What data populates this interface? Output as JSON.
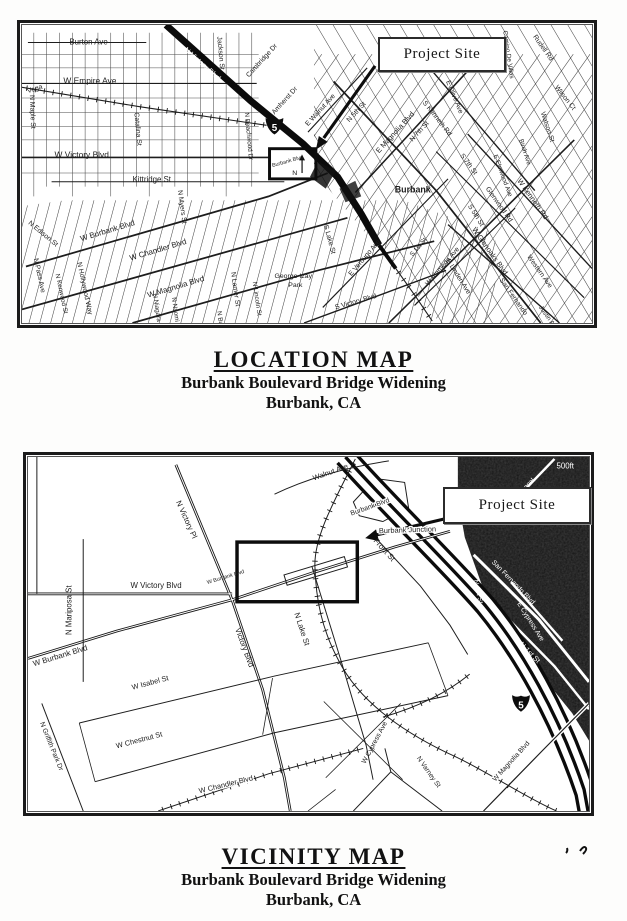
{
  "location_figure": {
    "project_site_label": "Project Site",
    "shield_label": "5",
    "compass_label": "N",
    "caption": {
      "title": "LOCATION MAP",
      "subtitle1": "Burbank Boulevard Bridge Widening",
      "subtitle2": "Burbank, CA"
    },
    "labels": [
      {
        "t": "Burton Ave",
        "x": 48,
        "y": 20,
        "r": 0,
        "s": 8
      },
      {
        "t": "W Empire Ave",
        "x": 42,
        "y": 60,
        "r": 0,
        "s": 8.5
      },
      {
        "t": "W Victory Blvd",
        "x": 33,
        "y": 136,
        "r": 0,
        "s": 8.5
      },
      {
        "t": "Kittridge St",
        "x": 112,
        "y": 161,
        "r": 0,
        "s": 8
      },
      {
        "t": "Vega",
        "x": 6,
        "y": 70,
        "r": -18,
        "s": 7
      },
      {
        "t": "N Maple St",
        "x": 8,
        "y": 72,
        "r": 88,
        "s": 7
      },
      {
        "t": "Catalina St",
        "x": 114,
        "y": 90,
        "r": 85,
        "s": 7
      },
      {
        "t": "Jackson St",
        "x": 198,
        "y": 12,
        "r": 85,
        "s": 7
      },
      {
        "t": "Cambridge Dr",
        "x": 230,
        "y": 54,
        "r": -48,
        "s": 7
      },
      {
        "t": "Amherst Dr",
        "x": 256,
        "y": 92,
        "r": -48,
        "s": 7
      },
      {
        "t": "N Victory Blvd",
        "x": 164,
        "y": 26,
        "r": 42,
        "s": 7.5,
        "c": "#ffffff"
      },
      {
        "t": "N Beachwood Dr",
        "x": 226,
        "y": 90,
        "r": 85,
        "s": 6.5
      },
      {
        "t": "E Walnut Ave",
        "x": 290,
        "y": 104,
        "r": -48,
        "s": 7
      },
      {
        "t": "N 5th St",
        "x": 332,
        "y": 100,
        "r": -48,
        "s": 7
      },
      {
        "t": "E Magnolia Blvd",
        "x": 362,
        "y": 132,
        "r": -48,
        "s": 7.5
      },
      {
        "t": "N 7th St",
        "x": 396,
        "y": 120,
        "r": -48,
        "s": 7
      },
      {
        "t": "S Kenneth Rd",
        "x": 406,
        "y": 80,
        "r": 52,
        "s": 7
      },
      {
        "t": "E Olive Ave",
        "x": 430,
        "y": 58,
        "r": 68,
        "s": 7
      },
      {
        "t": "Camino De Villas",
        "x": 488,
        "y": 6,
        "r": 82,
        "s": 6.5
      },
      {
        "t": "Rudell Rd",
        "x": 518,
        "y": 12,
        "r": 55,
        "s": 7
      },
      {
        "t": "Wilson Ct",
        "x": 540,
        "y": 64,
        "r": 52,
        "s": 7
      },
      {
        "t": "Watson St",
        "x": 526,
        "y": 90,
        "r": 72,
        "s": 7
      },
      {
        "t": "Birch Ave",
        "x": 504,
        "y": 118,
        "r": 72,
        "s": 6.5
      },
      {
        "t": "E Elmwood Ave",
        "x": 478,
        "y": 134,
        "r": 70,
        "s": 6.5
      },
      {
        "t": "S 7th St",
        "x": 444,
        "y": 134,
        "r": 54,
        "s": 7
      },
      {
        "t": "S 5th St",
        "x": 452,
        "y": 186,
        "r": 58,
        "s": 7
      },
      {
        "t": "Glenwood Rd",
        "x": 470,
        "y": 168,
        "r": 55,
        "s": 7
      },
      {
        "t": "W Kenneth Rd",
        "x": 502,
        "y": 160,
        "r": 55,
        "s": 7.5
      },
      {
        "t": "W Glenoaks Blvd",
        "x": 456,
        "y": 210,
        "r": 55,
        "s": 7.5
      },
      {
        "t": "E Linden Ave",
        "x": 430,
        "y": 242,
        "r": 58,
        "s": 7
      },
      {
        "t": "San Fernando",
        "x": 484,
        "y": 262,
        "r": 55,
        "s": 7
      },
      {
        "t": "Western Ave",
        "x": 512,
        "y": 238,
        "r": 55,
        "s": 7
      },
      {
        "t": "Justin Ave",
        "x": 524,
        "y": 290,
        "r": 55,
        "s": 6.5
      },
      {
        "t": "W Alameda Ave",
        "x": 412,
        "y": 268,
        "r": -50,
        "s": 7
      },
      {
        "t": "E Verdugo Ave",
        "x": 334,
        "y": 258,
        "r": -50,
        "s": 7
      },
      {
        "t": "S 1st St",
        "x": 396,
        "y": 238,
        "r": -50,
        "s": 6.5
      },
      {
        "t": "S Lake St",
        "x": 306,
        "y": 206,
        "r": 75,
        "s": 7
      },
      {
        "t": "S Victory Blvd",
        "x": 318,
        "y": 292,
        "r": -16,
        "s": 7
      },
      {
        "t": "George Izay",
        "x": 256,
        "y": 260,
        "r": 0,
        "s": 7
      },
      {
        "t": "Park",
        "x": 270,
        "y": 269,
        "r": 0,
        "s": 7
      },
      {
        "t": "N Lamer St",
        "x": 212,
        "y": 254,
        "r": 82,
        "s": 7
      },
      {
        "t": "N Lincoln St",
        "x": 234,
        "y": 264,
        "r": 82,
        "s": 6.5
      },
      {
        "t": "N Buena Vista",
        "x": 198,
        "y": 294,
        "r": 82,
        "s": 6.5
      },
      {
        "t": "N Naomi St",
        "x": 152,
        "y": 280,
        "r": 82,
        "s": 6.5
      },
      {
        "t": "N Niagara St",
        "x": 133,
        "y": 276,
        "r": 82,
        "s": 6.5
      },
      {
        "t": "N Myers St",
        "x": 158,
        "y": 170,
        "r": 82,
        "s": 7
      },
      {
        "t": "N Hollywood Way",
        "x": 56,
        "y": 244,
        "r": 78,
        "s": 7
      },
      {
        "t": "N Kenwood St",
        "x": 34,
        "y": 256,
        "r": 78,
        "s": 6.5
      },
      {
        "t": "N Pass Ave",
        "x": 12,
        "y": 240,
        "r": 78,
        "s": 7
      },
      {
        "t": "N Edison St",
        "x": 6,
        "y": 204,
        "r": 40,
        "s": 7
      },
      {
        "t": "W Burbank Blvd",
        "x": 60,
        "y": 222,
        "r": -17,
        "s": 8
      },
      {
        "t": "W Chandler Blvd",
        "x": 110,
        "y": 242,
        "r": -17,
        "s": 8
      },
      {
        "t": "W Magnolia Blvd",
        "x": 128,
        "y": 280,
        "r": -17,
        "s": 8
      },
      {
        "t": "Burbank",
        "x": 378,
        "y": 172,
        "r": 0,
        "s": 9,
        "w": 700
      },
      {
        "t": "Burbank Blvd",
        "x": 254,
        "y": 146,
        "r": -16,
        "s": 5.5
      }
    ]
  },
  "vicinity_figure": {
    "project_site_label": "Project Site",
    "shield_label": "5",
    "caption": {
      "title": "VICINITY MAP",
      "subtitle1": "Burbank Boulevard Bridge Widening",
      "subtitle2": "Burbank, CA"
    },
    "labels": [
      {
        "t": "Walnut Ave",
        "x": 290,
        "y": 24,
        "r": -20,
        "s": 7.5
      },
      {
        "t": "N Victory Pl",
        "x": 150,
        "y": 46,
        "r": 66,
        "s": 8
      },
      {
        "t": "W Victory Blvd",
        "x": 104,
        "y": 134,
        "r": 0,
        "s": 8
      },
      {
        "t": "N Mariposa St",
        "x": 44,
        "y": 182,
        "r": -90,
        "s": 8
      },
      {
        "t": "W Burbank Blvd",
        "x": 6,
        "y": 214,
        "r": -17,
        "s": 8
      },
      {
        "t": "W Burbank Blvd",
        "x": 182,
        "y": 130,
        "r": -17,
        "s": 5.5
      },
      {
        "t": "Victory Blvd",
        "x": 210,
        "y": 176,
        "r": 70,
        "s": 8
      },
      {
        "t": "N Lake St",
        "x": 270,
        "y": 160,
        "r": 72,
        "s": 8
      },
      {
        "t": "Front St",
        "x": 350,
        "y": 86,
        "r": 48,
        "s": 8
      },
      {
        "t": "Burbank Junction",
        "x": 356,
        "y": 78,
        "r": -2,
        "s": 7.5,
        "h": 1
      },
      {
        "t": "Burbank Blvd",
        "x": 328,
        "y": 60,
        "r": -20,
        "s": 7,
        "h": 1
      },
      {
        "t": "W Isabel St",
        "x": 106,
        "y": 238,
        "r": -15,
        "s": 7.5
      },
      {
        "t": "W Chestnut St",
        "x": 90,
        "y": 298,
        "r": -15,
        "s": 7.5
      },
      {
        "t": "N Griffith Park Dr",
        "x": 12,
        "y": 272,
        "r": 68,
        "s": 7
      },
      {
        "t": "W Chandler Blvd",
        "x": 174,
        "y": 344,
        "r": -14,
        "s": 7.5,
        "h": 1
      },
      {
        "t": "W Cypress Ave",
        "x": 342,
        "y": 314,
        "r": -62,
        "s": 7
      },
      {
        "t": "N Varney St",
        "x": 394,
        "y": 308,
        "r": 55,
        "s": 7
      },
      {
        "t": "W Magnolia Blvd",
        "x": 474,
        "y": 332,
        "r": -48,
        "s": 7,
        "h": 1
      },
      {
        "t": "San Fernando Blvd",
        "x": 470,
        "y": 108,
        "r": 46,
        "s": 7,
        "c": "#ffffff"
      },
      {
        "t": "N 1st St",
        "x": 452,
        "y": 126,
        "r": 78,
        "s": 7,
        "c": "#ffffff"
      },
      {
        "t": "N 1st St",
        "x": 498,
        "y": 192,
        "r": 46,
        "s": 7.5,
        "c": "#ffffff"
      },
      {
        "t": "E Cypress Ave",
        "x": 496,
        "y": 150,
        "r": 58,
        "s": 7,
        "c": "#ffffff"
      },
      {
        "t": "Tunnel",
        "x": 500,
        "y": 38,
        "r": -45,
        "s": 6.5,
        "c": "#ffffff"
      },
      {
        "t": "500ft",
        "x": 536,
        "y": 12,
        "r": 0,
        "s": 8,
        "c": "#ffffff"
      }
    ]
  }
}
